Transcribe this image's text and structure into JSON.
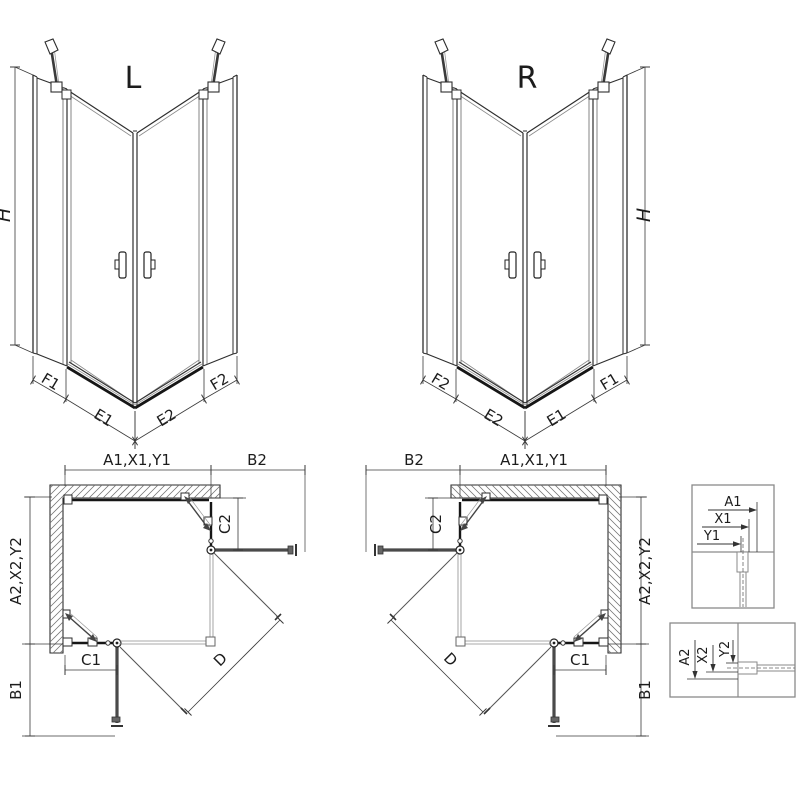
{
  "colors": {
    "background": "#ffffff",
    "line": "#2e2e2e",
    "dim_line": "#3a3a3a",
    "panel_dark": "#161616",
    "panel_gray": "#4a4a4a",
    "hatch": "#707070",
    "box_border": "#8a8a8a",
    "thin": "#8d8d8d",
    "text": "#1c1c1c"
  },
  "iso_left": {
    "title": "L",
    "height_label": "H",
    "segment_labels": [
      "F1",
      "E1",
      "E2",
      "F2"
    ]
  },
  "iso_right": {
    "title": "R",
    "height_label": "H",
    "segment_labels": [
      "F2",
      "E2",
      "E1",
      "F1"
    ]
  },
  "plan_left": {
    "width_label": "A1,X1,Y1",
    "return_top_label": "B2",
    "fixed_top_label": "C2",
    "depth_label": "A2,X2,Y2",
    "fixed_bottom_label": "C1",
    "return_bottom_label": "B1",
    "entry_label": "D"
  },
  "plan_right": {
    "width_label": "A1,X1,Y1",
    "return_top_label": "B2",
    "fixed_top_label": "C2",
    "depth_label": "A2,X2,Y2",
    "fixed_bottom_label": "C1",
    "return_bottom_label": "B1",
    "entry_label": "D"
  },
  "detail_top": {
    "labels": [
      "A1",
      "X1",
      "Y1"
    ]
  },
  "detail_bottom": {
    "labels": [
      "A2",
      "X2",
      "Y2"
    ]
  }
}
